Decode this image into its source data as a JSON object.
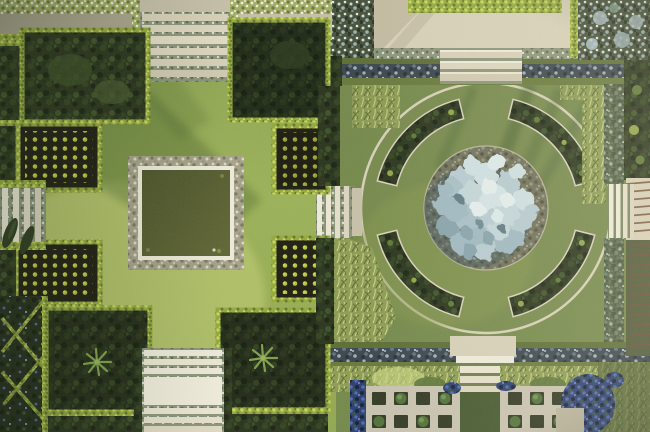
{
  "scene": {
    "title": "Top-down aerial photograph of a formal garden with a square reflecting pond parterre and a circular parterre with a silver-blue specimen tree",
    "left_garden": "stepped lawn cross around a square pond, clipped dark beds with dot-grid plantings, grass steps on all four sides",
    "right_garden": "circular lawn with four curved hedge beds around a central round bed holding a large silver-blue tree",
    "features": [
      "grass-and-stone steps",
      "blue-grey gravel paths",
      "clipped bright hedges",
      "swirl parterre with blue flowers",
      "pergola walk with rafter shadows",
      "paved topiary grid plots",
      "ornamental grass drifts",
      "long tree shadows"
    ]
  },
  "counts": {
    "arc_beds": 4,
    "dot_grid_beds": 4,
    "topiary_plots": 2,
    "columnar_trees": 2
  },
  "colors": {
    "lawn_left_top": "#8aa04e",
    "lawn_left_mid": "#9cb257",
    "lawn_left_low": "#93a850",
    "lawn_left_hi": "#c8d379",
    "lawn_right": "#74894a",
    "lawn_right_soft": "#87994e",
    "bed_dark": "#29331b",
    "bed_blob_light": "#3c5126",
    "bed_blob_dark": "#19230f",
    "hedge": "#94a93c",
    "hedge_hi": "#c8d75a",
    "hedge_lo": "#66782c",
    "hedge_line": "#5c6d33",
    "hedge_line2": "#67793a",
    "flower_hedge": "#a3ad62",
    "flower_fleck": "#eef0de",
    "soil": "#1d1c10",
    "plant_dot": "#b9c53b",
    "plant_dot_hi": "#d6e055",
    "stone": "#d8d1b8",
    "stone_hi": "#f0ecdb",
    "stone_lo": "#bdb69e",
    "water_deep": "#4d5328",
    "water_light": "#5f6633",
    "pond_border": "#a5a189",
    "pond_fleck": "#ded9c6",
    "pond_fleck_dark": "#767a5e",
    "gravel": "#3a444c",
    "gravel_hi": "#9fb2ba",
    "gravel_mid": "#5f737d",
    "gravel_dark": "#272f35",
    "silver": "#b7ccd2",
    "silver_hi": "#e4efee",
    "silver_lo": "#87a3ab",
    "silver_deep": "#5e7a84",
    "silver_bed": "#6f705a",
    "silver_bed_hi": "#94957c",
    "blue_flowers": "#2a3e6d",
    "blue_hi": "#4d69b0",
    "blue_deep": "#141d38",
    "grass_tuft": "#8d9c54",
    "grass_hi": "#cdd983",
    "grass_lo": "#5a6b33",
    "rafter": "#6f4c34",
    "tree_column": "#2c3a1e",
    "riser": "#8b957a",
    "shadow_green": "#2e4a22",
    "plot_paving": "#c9c3b0",
    "plot_hole": "#303722",
    "shrub": "#4f7036",
    "shrub_hi": "#6f9350",
    "grass_path": "#44582d"
  }
}
